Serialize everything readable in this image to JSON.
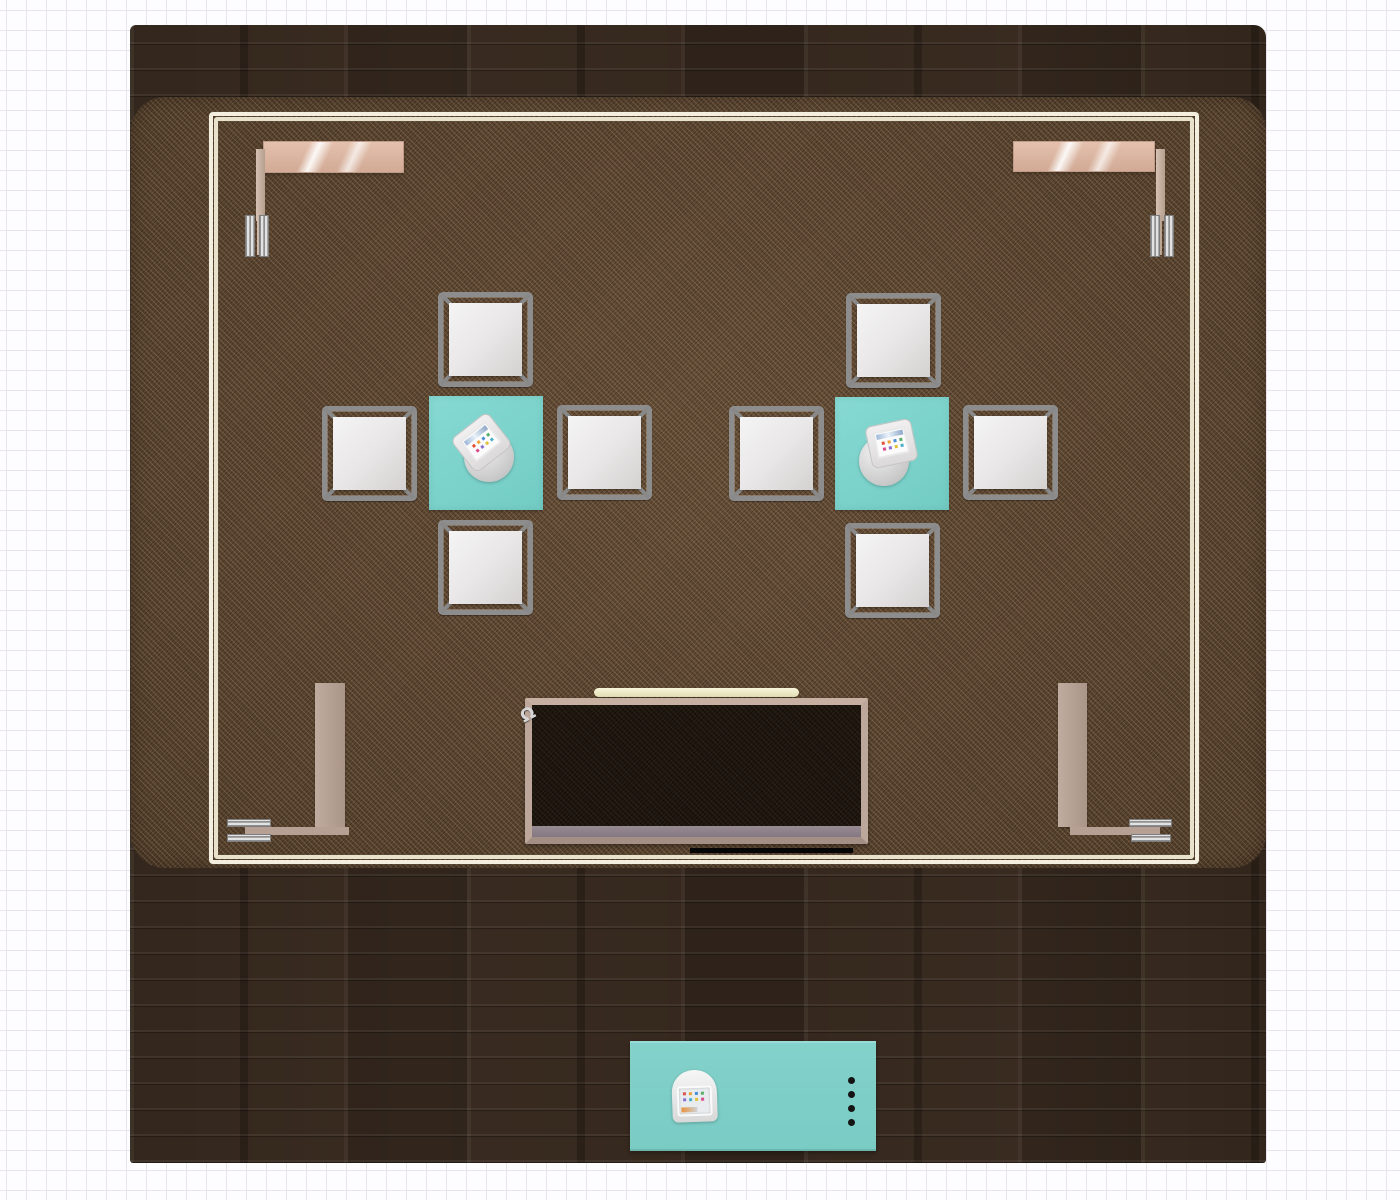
{
  "view": {
    "type": "interior-design-floor-plan-top-view",
    "background": "grid-paper",
    "grid_size_px": 20,
    "canvas_size": {
      "width": 1400,
      "height": 1200
    }
  },
  "palette": {
    "accent_teal": "#7ed3cc",
    "console_teal": "#7fccc6",
    "rug_brown": "#5b4531",
    "wood_dark": "#392b20",
    "trim_cream": "#f3eede",
    "chair_metal": "#8d8d8d",
    "lamp_rosegold": "#ddb9a6",
    "panel_taupe": "#b5a194",
    "desk_top_dark": "#1e1710"
  },
  "room": {
    "floor": "dark-wood-planks",
    "x": 130,
    "y": 25,
    "w": 1136,
    "h": 1138,
    "rug": {
      "x": 131,
      "y": 97,
      "w": 1135,
      "h": 771,
      "texture": "woven-carpet"
    },
    "trim_rail": {
      "x": 209,
      "y": 112,
      "w": 990,
      "h": 752
    }
  },
  "desk": {
    "hook_glyph": "Ω"
  },
  "furniture": [
    {
      "id": "wall-light-top-left",
      "type": "swing-arm-light",
      "x": 245,
      "y": 141,
      "w": 159,
      "h": 116
    },
    {
      "id": "wall-light-top-right",
      "type": "swing-arm-light",
      "x": 1013,
      "y": 141,
      "w": 159,
      "h": 116
    },
    {
      "id": "dining-set-left",
      "type": "square-table-4-chairs",
      "table": {
        "x": 429,
        "y": 396,
        "w": 114,
        "h": 114
      },
      "chairs": 4,
      "tablet_kiosk": true
    },
    {
      "id": "dining-set-right",
      "type": "square-table-4-chairs",
      "table": {
        "x": 835,
        "y": 397,
        "w": 114,
        "h": 113
      },
      "chairs": 4,
      "tablet_kiosk": true
    },
    {
      "id": "media-desk",
      "type": "dark-top-desk",
      "x": 525,
      "y": 698,
      "w": 343,
      "h": 146,
      "light_bar": {
        "x": 594,
        "y": 688,
        "w": 205,
        "h": 9
      }
    },
    {
      "id": "side-panel-left",
      "type": "upright-panel",
      "x": 315,
      "y": 683,
      "w": 30,
      "h": 144
    },
    {
      "id": "side-panel-right",
      "type": "upright-panel",
      "x": 1058,
      "y": 683,
      "w": 29,
      "h": 144
    },
    {
      "id": "floor-lamp-bottom-left",
      "type": "swing-arm-light",
      "x": 227,
      "y": 683
    },
    {
      "id": "floor-lamp-bottom-right",
      "type": "swing-arm-light",
      "x": 1048,
      "y": 683
    },
    {
      "id": "console-table-bottom",
      "type": "console-table",
      "x": 630,
      "y": 1041,
      "w": 246,
      "h": 110,
      "knob_count": 4,
      "tablet_kiosk": true
    }
  ]
}
